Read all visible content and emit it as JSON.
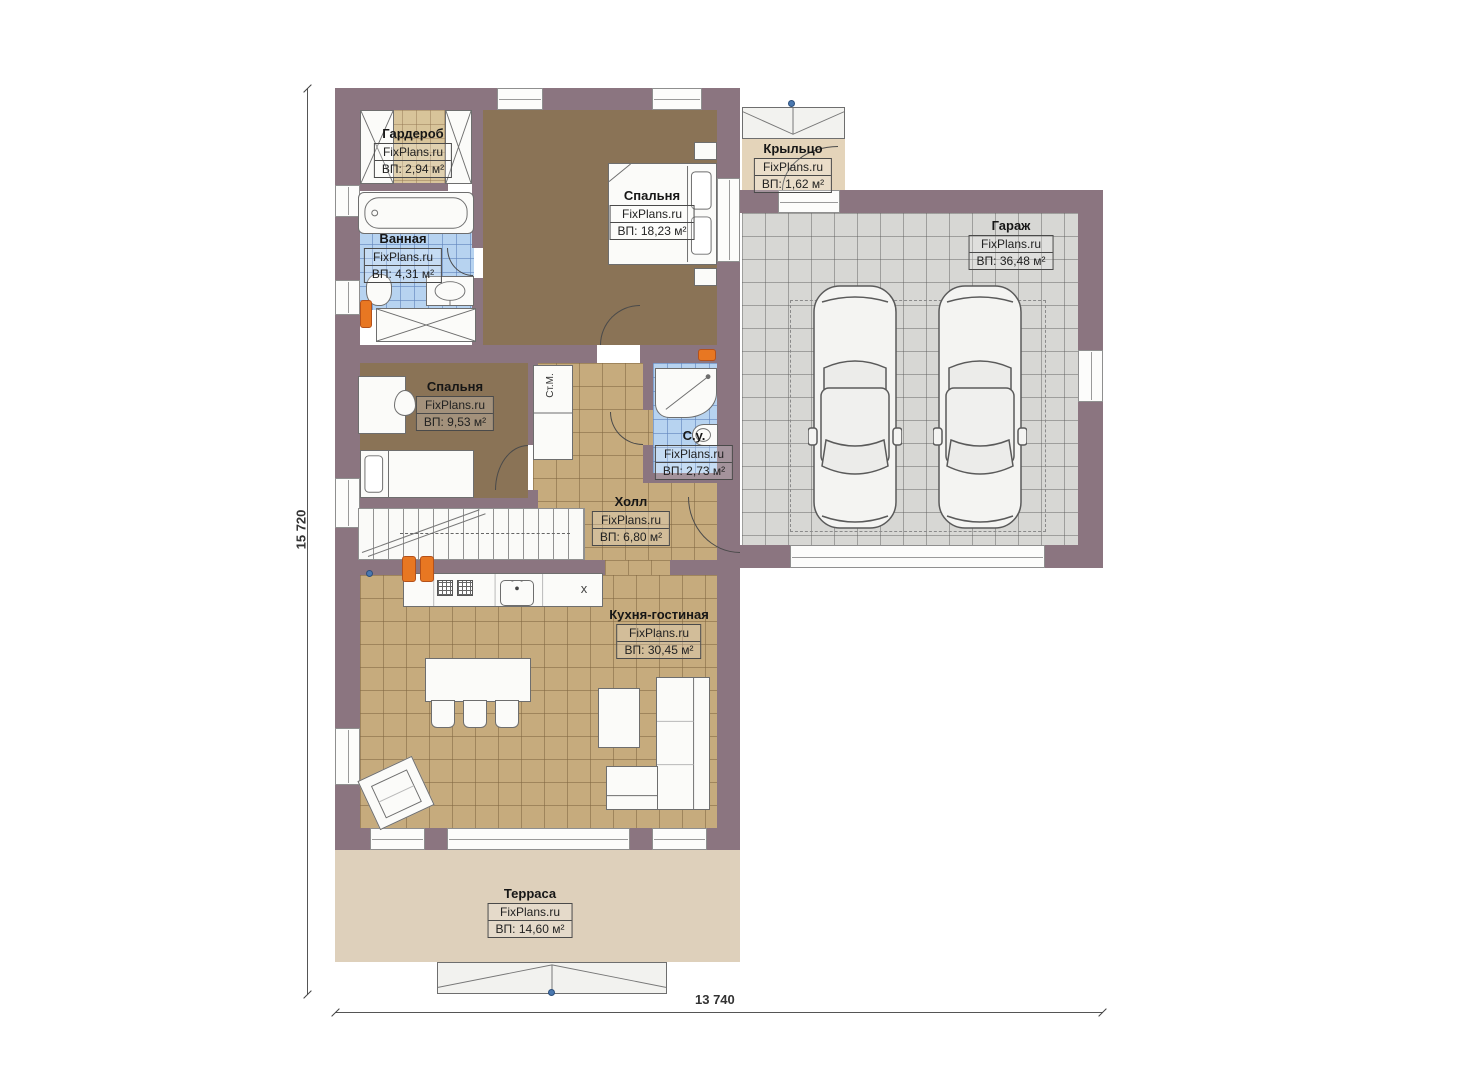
{
  "brand": "FixPlans.ru",
  "rooms": [
    {
      "id": "wardrobe",
      "name": "Гардероб",
      "area": "ВП: 2,94 м²"
    },
    {
      "id": "bathroom",
      "name": "Ванная",
      "area": "ВП: 4,31 м²"
    },
    {
      "id": "bedroom1",
      "name": "Спальня",
      "area": "ВП: 18,23 м²"
    },
    {
      "id": "porch",
      "name": "Крыльцо",
      "area": "ВП: 1,62 м²"
    },
    {
      "id": "garage",
      "name": "Гараж",
      "area": "ВП: 36,48 м²"
    },
    {
      "id": "bedroom2",
      "name": "Спальня",
      "area": "ВП: 9,53 м²"
    },
    {
      "id": "wc",
      "name": "С.у.",
      "area": "ВП: 2,73 м²"
    },
    {
      "id": "hall",
      "name": "Холл",
      "area": "ВП: 6,80 м²"
    },
    {
      "id": "kitchen",
      "name": "Кухня-гостиная",
      "area": "ВП: 30,45 м²"
    },
    {
      "id": "terrace",
      "name": "Терраса",
      "area": "ВП: 14,60 м²"
    }
  ],
  "annotations": {
    "washing_machine": "Ст.М."
  },
  "icons": {
    "dishwasher": "x"
  },
  "dimensions": {
    "height_label": "15 720",
    "width_label": "13 740"
  },
  "colors": {
    "wall": "#8b7580",
    "floor_dark": "#8a7356",
    "floor_tile": "#c6ab7d",
    "floor_garage": "#d7d7d4",
    "floor_wet": "#b7d3f0",
    "floor_wardrobe": "#d8c49a",
    "floor_terrace": "#ded0bb",
    "radiator": "#e87722",
    "reference_point": "#4a78b0"
  }
}
